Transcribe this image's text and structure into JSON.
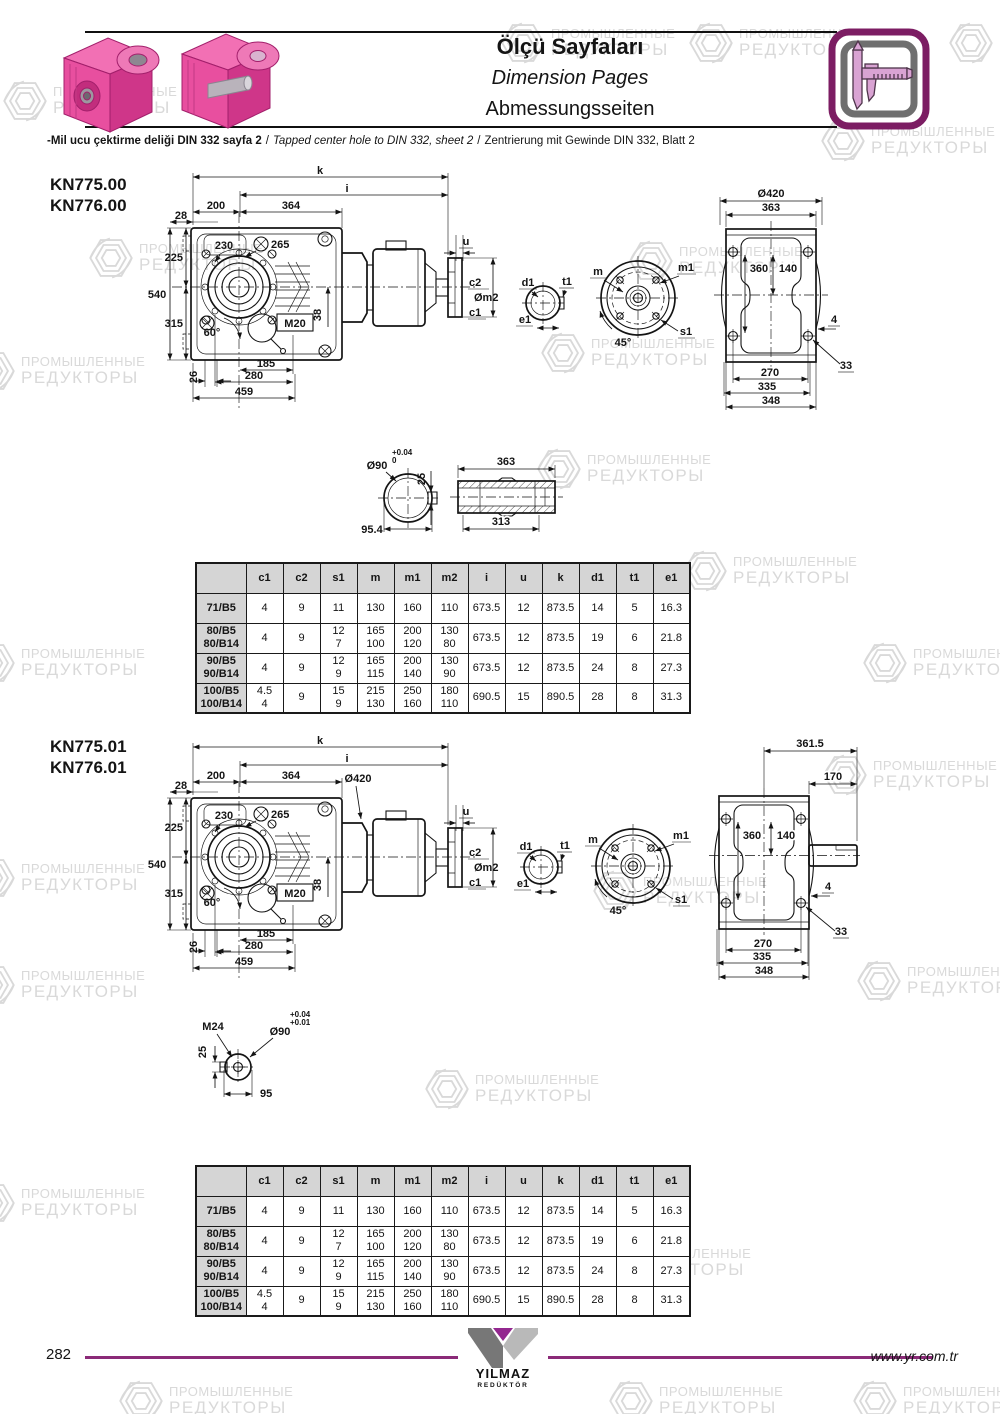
{
  "watermark": {
    "line1": "ПРОМЫШЛЕННЫЕ",
    "line2": "РЕДУКТОРЫ"
  },
  "header": {
    "title_tr": "Ölçü Sayfaları",
    "title_en": "Dimension Pages",
    "title_de": "Abmessungsseiten",
    "note_tr": "-Mil ucu çektirme deliği DIN 332 sayfa 2",
    "note_sep1": "/",
    "note_en": "Tapped center hole to DIN 332, sheet 2",
    "note_sep2": "/",
    "note_de": "Zentrierung mit Gewinde DIN 332, Blatt 2"
  },
  "sections": [
    {
      "model1": "KN775.00",
      "model2": "KN776.00",
      "side": {
        "k": "k",
        "i": "i",
        "w200": "200",
        "w364": "364",
        "w28": "28",
        "d230": "230",
        "d265": "265",
        "h225": "225",
        "h540": "540",
        "h315": "315",
        "a60": "60°",
        "m20": "M20",
        "h38": "38",
        "h26": "26",
        "w185": "185",
        "w280": "280",
        "w459": "459",
        "u": "u",
        "c2": "c2",
        "om2": "Øm2",
        "c1": "c1"
      },
      "det": {
        "d1": "d1",
        "t1": "t1",
        "e1": "e1"
      },
      "flg": {
        "m": "m",
        "m1": "m1",
        "a45": "45°",
        "s1": "s1"
      },
      "rear": {
        "t1": "Ø420",
        "t2": "363",
        "v1": "360",
        "v2": "140",
        "s4": "4",
        "h33": "33",
        "b1": "270",
        "b2": "335",
        "b3": "348"
      },
      "shaft": {
        "d90": "Ø90",
        "tp": "+0.04",
        "tb": "0",
        "k25": "25",
        "l1": "363",
        "l2": "313",
        "w": "95.4"
      }
    },
    {
      "model1": "KN775.01",
      "model2": "KN776.01",
      "side": {
        "k": "k",
        "i": "i",
        "w200": "200",
        "w364": "364",
        "w28": "28",
        "d230": "230",
        "d265": "265",
        "h225": "225",
        "h540": "540",
        "h315": "315",
        "a60": "60°",
        "m20": "M20",
        "h38": "38",
        "h26": "26",
        "w185": "185",
        "w280": "280",
        "w459": "459",
        "u": "u",
        "c2": "c2",
        "om2": "Øm2",
        "c1": "c1",
        "o420": "Ø420"
      },
      "det": {
        "d1": "d1",
        "t1": "t1",
        "e1": "e1"
      },
      "flg": {
        "m": "m",
        "m1": "m1",
        "a45": "45°",
        "s1": "s1"
      },
      "rear": {
        "t1": "361.5",
        "t2": "170",
        "v1": "360",
        "v2": "140",
        "s4": "4",
        "h33": "33",
        "b1": "270",
        "b2": "335",
        "b3": "348"
      },
      "shaft": {
        "m24": "M24",
        "d90": "Ø90",
        "tp": "+0.04",
        "tb": "+0.01",
        "k25": "25",
        "w": "95"
      }
    }
  ],
  "table": {
    "headers": [
      "",
      "c1",
      "c2",
      "s1",
      "m",
      "m1",
      "m2",
      "i",
      "u",
      "k",
      "d1",
      "t1",
      "e1"
    ],
    "rows": [
      {
        "label": "71/B5",
        "values": [
          "4",
          "9",
          "11",
          "130",
          "160",
          "110",
          "673.5",
          "12",
          "873.5",
          "14",
          "5",
          "16.3"
        ]
      },
      {
        "label": "80/B5\n80/B14",
        "values": [
          "4",
          "9",
          "12\n7",
          "165\n100",
          "200\n120",
          "130\n80",
          "673.5",
          "12",
          "873.5",
          "19",
          "6",
          "21.8"
        ]
      },
      {
        "label": "90/B5\n90/B14",
        "values": [
          "4",
          "9",
          "12\n9",
          "165\n115",
          "200\n140",
          "130\n90",
          "673.5",
          "12",
          "873.5",
          "24",
          "8",
          "27.3"
        ]
      },
      {
        "label": "100/B5\n100/B14",
        "values": [
          "4.5\n4",
          "9",
          "15\n9",
          "215\n130",
          "250\n160",
          "180\n110",
          "690.5",
          "15",
          "890.5",
          "28",
          "8",
          "31.3"
        ]
      }
    ]
  },
  "footer": {
    "page": "282",
    "brand1": "YILMAZ",
    "brand2": "REDÜKTÖR",
    "url": "www.yr.com.tr"
  },
  "colors": {
    "line": "#8b2a78",
    "pink": "#e84f9f",
    "icon_border": "#7c1d63",
    "table_header_bg": "#d5d5d5",
    "watermark": "#d9d9d9"
  }
}
